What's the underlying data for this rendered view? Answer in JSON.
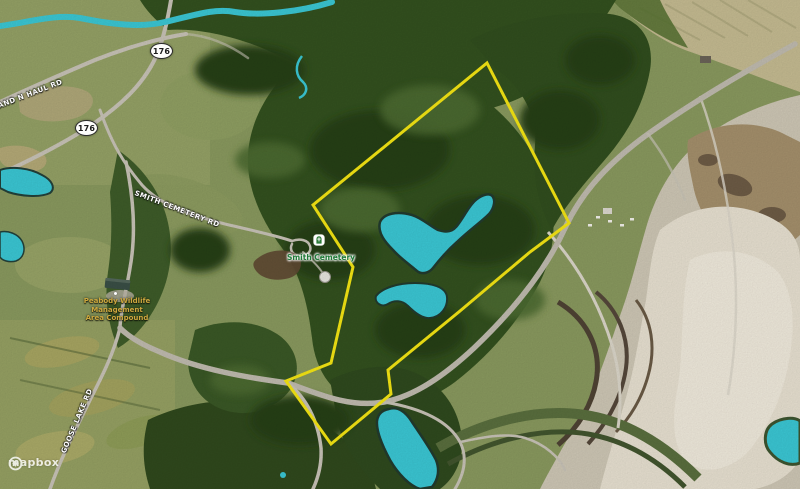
{
  "attribution": {
    "logo_text": "mapbox",
    "logo_icon": "mapbox-logo-icon"
  },
  "road_shields": [
    {
      "label": "176"
    },
    {
      "label": "176"
    }
  ],
  "road_labels": [
    {
      "id": "haul-road",
      "text": "AND N HAUL RD"
    },
    {
      "id": "smith-cemetery-rd",
      "text": "SMITH CEMETERY RD"
    },
    {
      "id": "goose-lake-rd",
      "text": "GOOSE LAKE RD"
    }
  ],
  "poi_labels": [
    {
      "id": "smith-cemetery",
      "text": "Smith Cemetery",
      "icon": "cemetery-icon",
      "color": "#1f7a38"
    },
    {
      "id": "peabody-compound",
      "lines": [
        "Peabody Wildlife",
        "Management",
        "Area Compound"
      ],
      "color": "#cda83e"
    }
  ],
  "overlay_colors": {
    "property_boundary": "#f6e714",
    "water": "#3bc8d5",
    "road_shield_text": "#1c1c1c"
  }
}
